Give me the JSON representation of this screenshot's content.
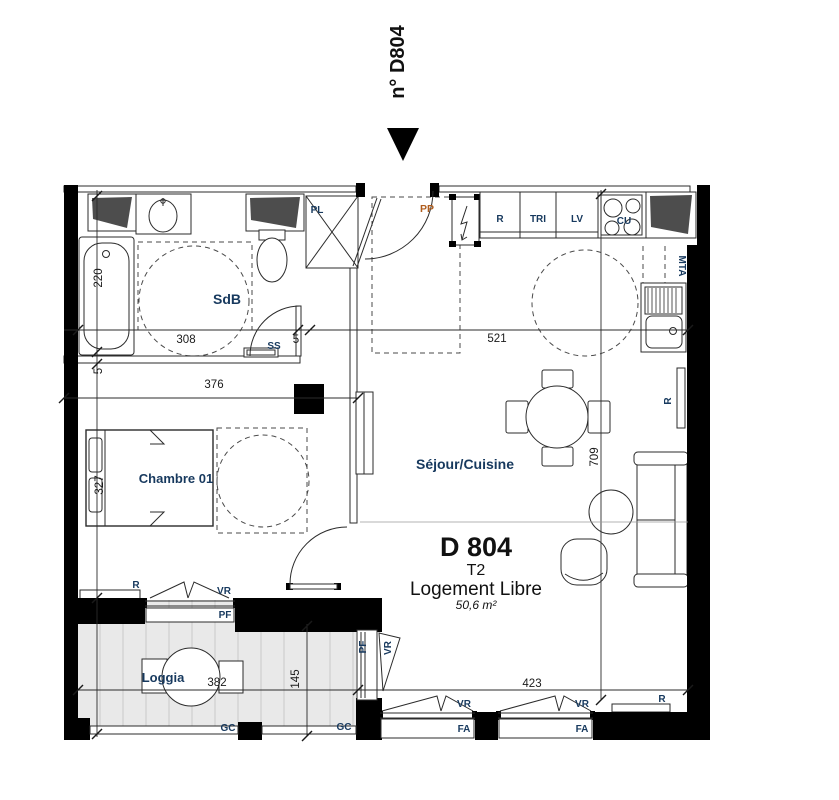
{
  "colors": {
    "label_navy": "#17395e",
    "entry_orange": "#b05d1e",
    "dimension_text": "#1a1a1a",
    "wall_black": "#000000",
    "loggia_floor": "#e9e9e9"
  },
  "marker": {
    "unit_label": "n° D804"
  },
  "unit_info": {
    "number": "D 804",
    "type": "T2",
    "status": "Logement Libre",
    "area": "50,6 m²"
  },
  "rooms": {
    "bathroom": "SdB",
    "bedroom": "Chambre 01",
    "living": "Séjour/Cuisine",
    "loggia": "Loggia"
  },
  "equipment": {
    "closet": "PL",
    "entry_door": "PP",
    "fridge": "R",
    "waste_sorting": "TRI",
    "dishwasher": "LV",
    "cooktop": "CU",
    "duct": "MTA",
    "towel_rail": "SS",
    "radiator": "R",
    "roller_shutter": "VR",
    "french_window": "PF",
    "fixed_window": "FA",
    "guardrail": "GC"
  },
  "dimensions": {
    "bathroom_depth": "220",
    "bathroom_width": "308",
    "partition_a": "5",
    "partition_b": "5",
    "living_width": "521",
    "bedroom_width": "376",
    "bedroom_depth": "327",
    "living_depth": "709",
    "loggia_width": "382",
    "loggia_depth": "145",
    "windows_span": "423"
  }
}
